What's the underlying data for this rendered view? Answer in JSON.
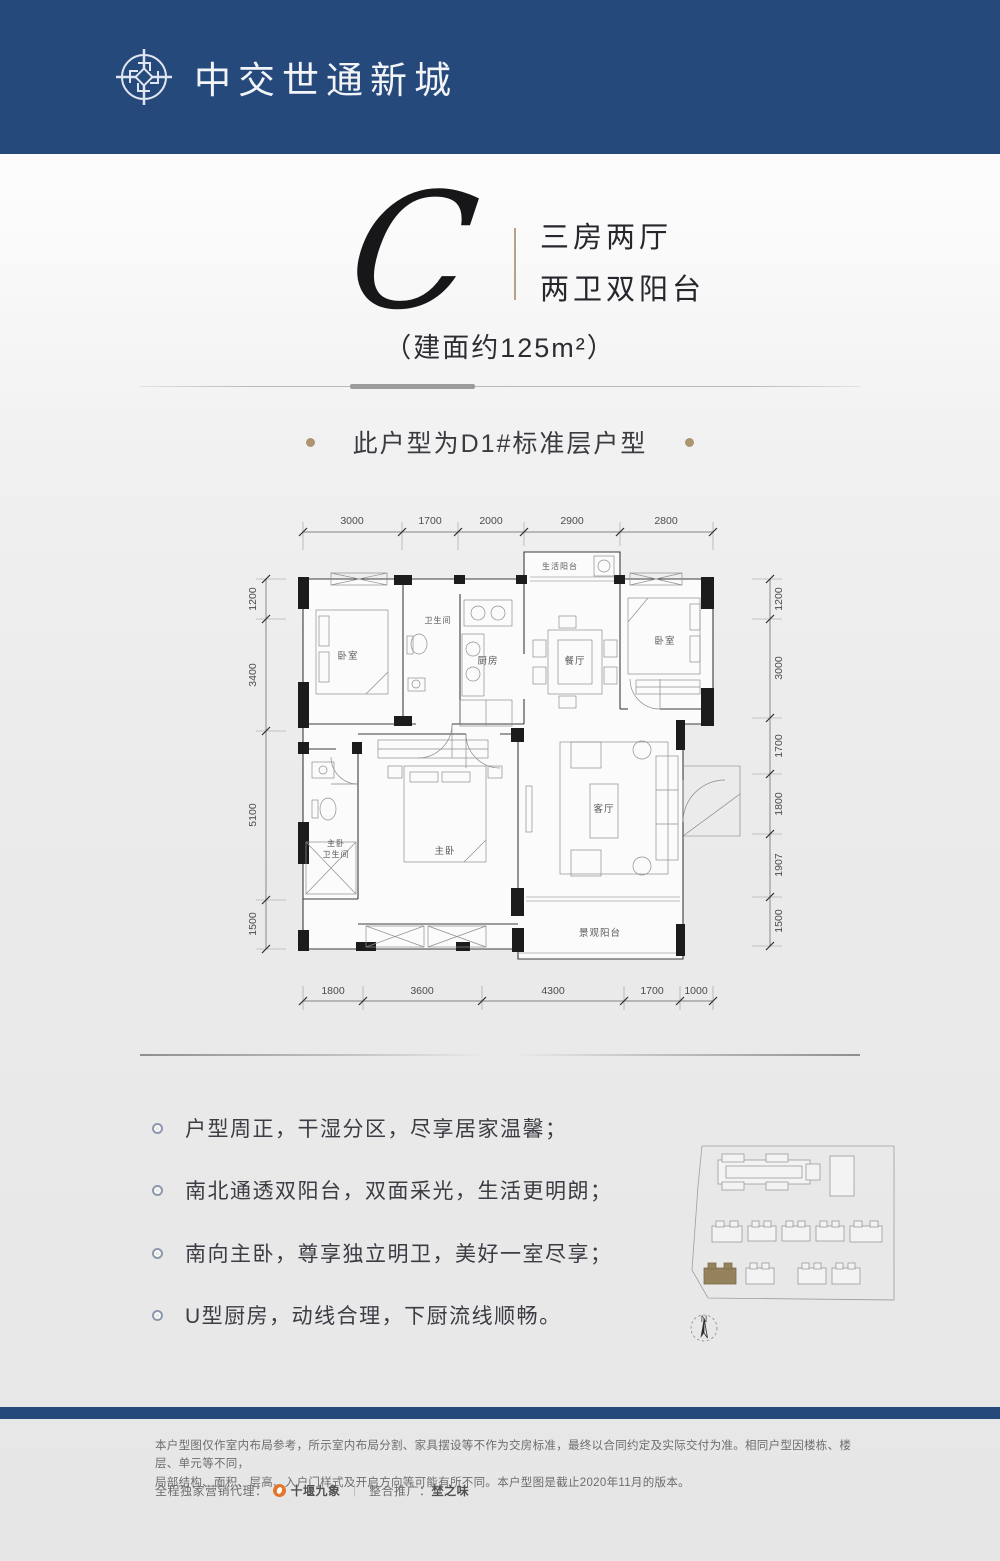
{
  "header": {
    "brand": "中交世通新城"
  },
  "unit": {
    "letter": "C",
    "tagline": [
      "三房两厅",
      "两卫双阳台"
    ],
    "area_note": "（建面约125m²）"
  },
  "subtitle": "此户型为D1#标准层户型",
  "plan": {
    "rooms": {
      "bedroom_left": "卧室",
      "bathroom": "卫生间",
      "kitchen": "厨房",
      "dining": "餐厅",
      "service_balcony": "生活阳台",
      "bedroom_right": "卧室",
      "master_bedroom": "主卧",
      "master_bath1": "主卧",
      "master_bath2": "卫生间",
      "living": "客厅",
      "view_balcony": "景观阳台"
    },
    "dims": {
      "top": [
        "3000",
        "1700",
        "2000",
        "2900",
        "2800"
      ],
      "bottom": [
        "1800",
        "3600",
        "4300",
        "1700",
        "1000"
      ],
      "left": [
        "1200",
        "3400",
        "5100",
        "1500"
      ],
      "right": [
        "1200",
        "3000",
        "1700",
        "1800",
        "1907",
        "1500"
      ]
    }
  },
  "features": [
    "户型周正，干湿分区，尽享居家温馨；",
    "南北通透双阳台，双面采光，生活更明朗；",
    "南向主卧，尊享独立明卫，美好一室尽享；",
    "U型厨房，动线合理，下厨流线顺畅。"
  ],
  "sitemap": {
    "compass": "N"
  },
  "footer": {
    "disclaimer_line1": "本户型图仅作室内布局参考，所示室内布局分割、家具摆设等不作为交房标准，最终以合同约定及实际交付为准。相同户型因楼栋、楼层、单元等不同，",
    "disclaimer_line2": "局部结构、面积、层高、入户门样式及开启方向等可能有所不同。本户型图是截止2020年11月的版本。",
    "agency_prefix": "全程独家营销代理：",
    "agency_name": "十堰九象",
    "promo_label": "整合推广：",
    "promo_name": "埜之味"
  }
}
